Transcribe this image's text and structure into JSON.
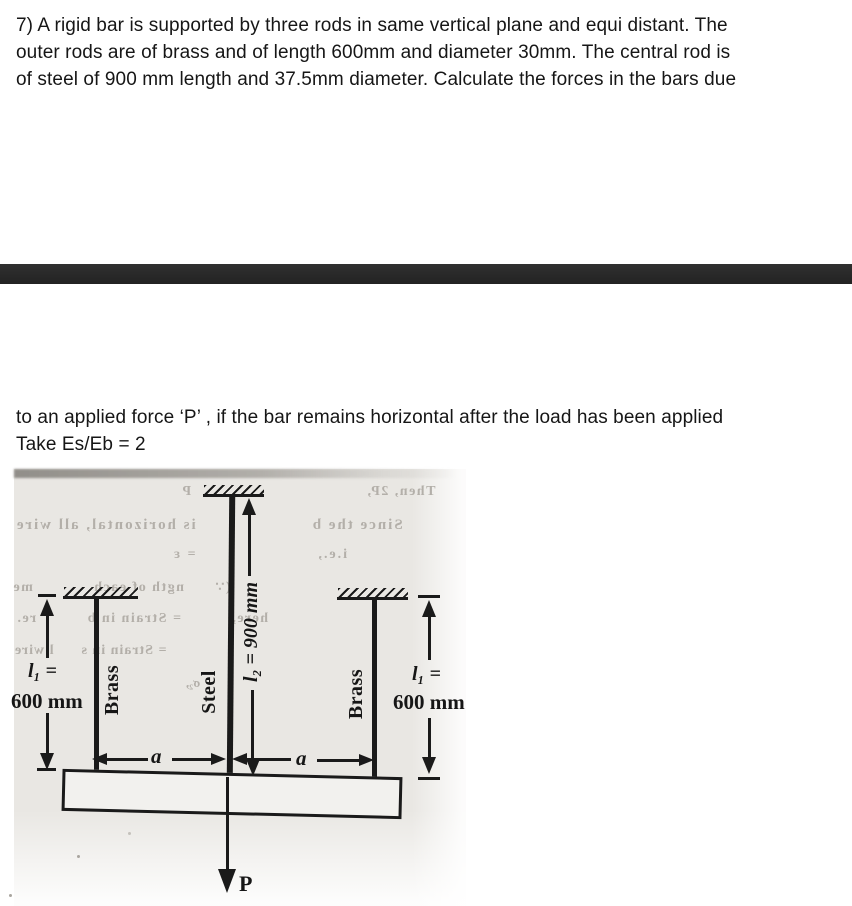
{
  "problem": {
    "para1": [
      "7) A rigid bar is supported by three rods in same vertical plane and equi distant. The",
      "outer rods are of brass and of length 600mm and diameter 30mm. The central rod is",
      "of steel of 900 mm length and 37.5mm diameter. Calculate the forces in the bars due"
    ],
    "para2": [
      "to an applied force ‘P’ , if the bar remains horizontal after the load has been applied",
      "Take Es/Eb = 2"
    ]
  },
  "figure": {
    "left_rod_label": "Brass",
    "center_rod_label": "Steel",
    "right_rod_label": "Brass",
    "left_length_symbol": "l₁ =",
    "left_length_value": "600 mm",
    "right_length_symbol": "l₁ =",
    "right_length_value": "600 mm",
    "center_length_label": "l₂ = 900 mm",
    "spacing_left_label": "a",
    "spacing_right_label": "a",
    "force_label": "P",
    "bleedthrough": {
      "line1": "Then, 2P,                                   P",
      "line2": "Since the b                    is horizontal, all wire",
      "line3": "i.e.,                      = ε",
      "line4": "(∵      ngth of each            me",
      "line5": "here,          = Strain in b          re.",
      "line6": "= Strain in s      l wire",
      "line7": "σ₂,"
    }
  },
  "colors": {
    "divider": "#2a2a2a",
    "ink": "#1a1a1a",
    "paper": "#e9e7e3",
    "bleed_text": "#b3afa9"
  }
}
